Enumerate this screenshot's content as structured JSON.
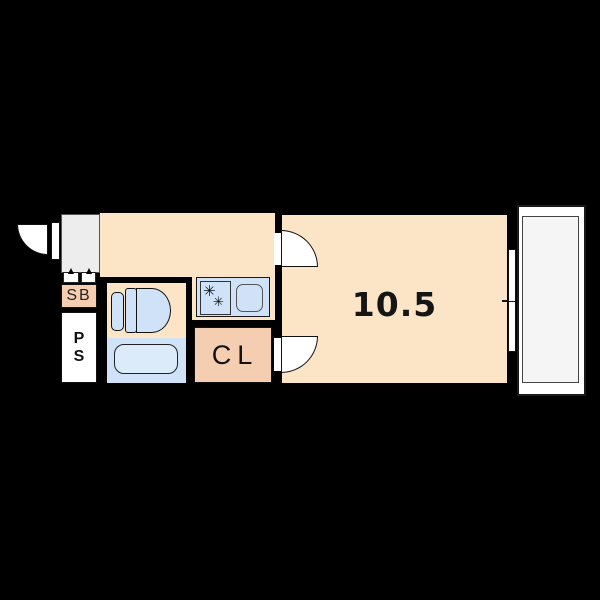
{
  "floorplan": {
    "labels": {
      "shoe_box": "SB",
      "pipe_space": [
        "P",
        "S"
      ],
      "closet": "CL",
      "main_room_size": "10.5"
    },
    "icons": {
      "burner_glyph": "✳",
      "entrance_door": "quarter-circle-swing",
      "room_doors": "quarter-circle-swing",
      "window": "sliding-window-two-panes"
    },
    "colors": {
      "wall": "#000000",
      "room": "#fbe5c6",
      "closet": "#f5cdb0",
      "fixture": "#cfe2f7",
      "tub": "#dcebfa",
      "genkan": "#ededed",
      "balcony": "#f5f5f5"
    }
  }
}
